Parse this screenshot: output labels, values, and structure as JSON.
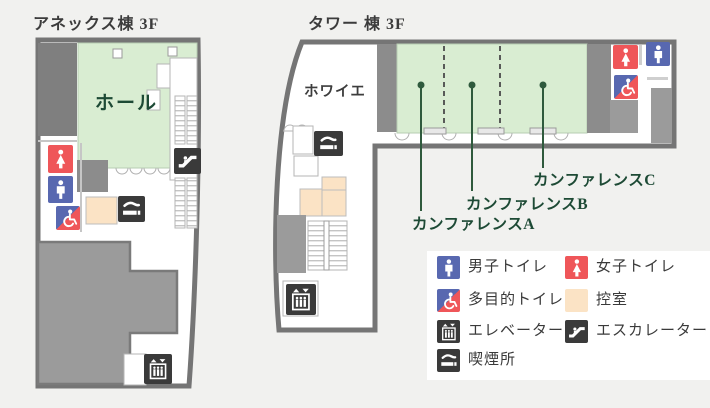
{
  "annex": {
    "title": "アネックス棟 3F",
    "hall_label": "ホール"
  },
  "tower": {
    "title": "タワー 棟 3F",
    "foyer_label": "ホワイエ",
    "conference_a": "カンファレンスA",
    "conference_b": "カンファレンスB",
    "conference_c": "カンファレンスC"
  },
  "legend": {
    "items": [
      {
        "icon": "male-toilet-icon",
        "label": "男子トイレ"
      },
      {
        "icon": "female-toilet-icon",
        "label": "女子トイレ"
      },
      {
        "icon": "multipurpose-toilet-icon",
        "label": "多目的トイレ"
      },
      {
        "icon": "waiting-room-swatch",
        "label": "控室"
      },
      {
        "icon": "elevator-icon",
        "label": "エレベーター"
      },
      {
        "icon": "escalator-icon",
        "label": "エスカレーター"
      },
      {
        "icon": "smoking-area-icon",
        "label": "喫煙所"
      }
    ]
  },
  "colors": {
    "background": "#f1f1ef",
    "wall": "#757575",
    "room_green": "#d9edd2",
    "waiting_room_peach": "#fbe3c5",
    "male_blue": "#5868b0",
    "female_red": "#ef5659",
    "icon_dark": "#3a3a3a",
    "label_green": "#1d4a35"
  }
}
